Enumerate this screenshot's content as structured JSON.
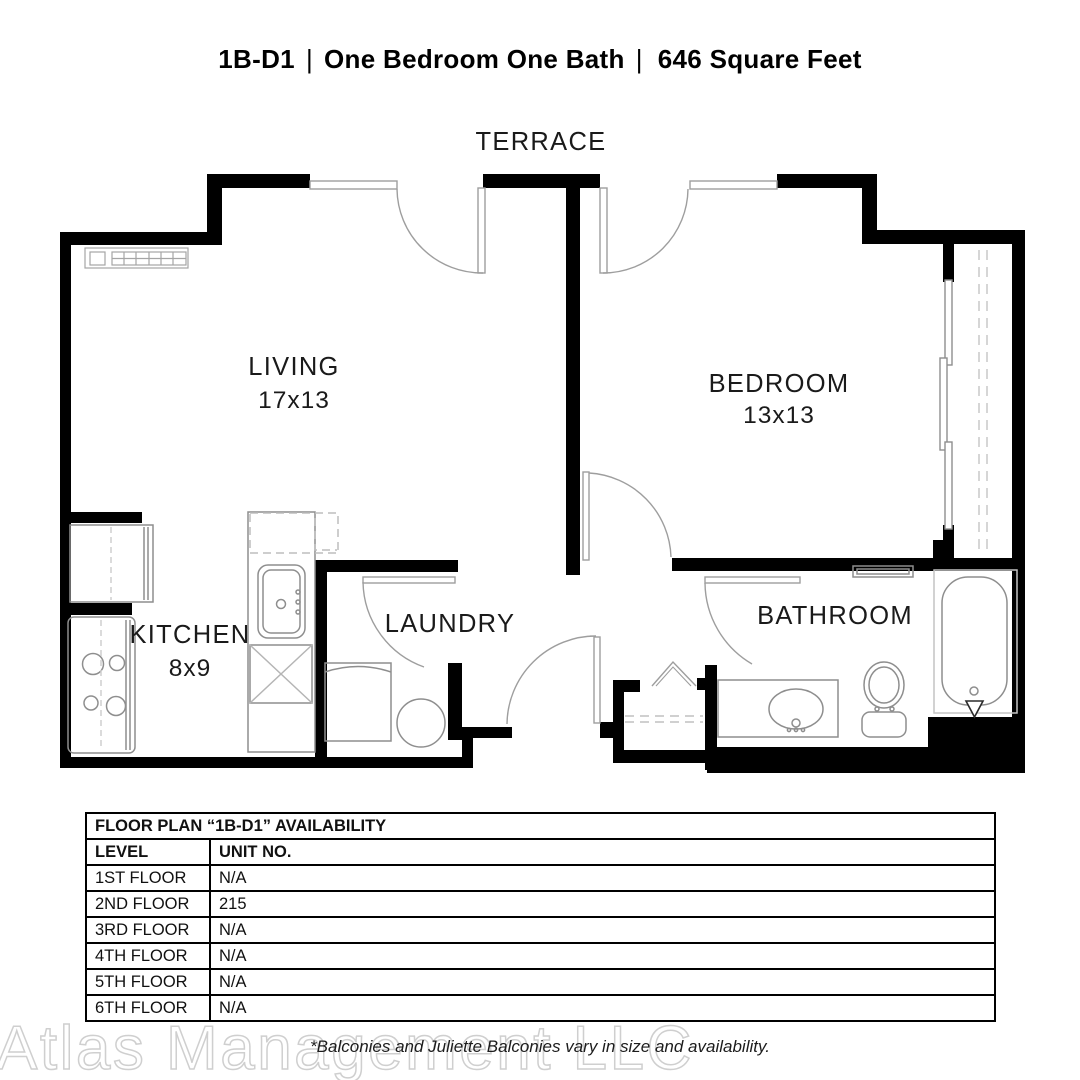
{
  "header": {
    "code": "1B-D1",
    "sep": "|",
    "name": "One Bedroom One Bath",
    "sqft": "646 Square Feet"
  },
  "plan": {
    "terrace": "TERRACE",
    "living": {
      "name": "LIVING",
      "dims": "17x13"
    },
    "bedroom": {
      "name": "BEDROOM",
      "dims": "13x13"
    },
    "kitchen": {
      "name": "KITCHEN",
      "dims": "8x9"
    },
    "laundry": {
      "name": "LAUNDRY"
    },
    "bathroom": {
      "name": "BATHROOM"
    }
  },
  "table": {
    "title": "FLOOR PLAN “1B-D1” AVAILABILITY",
    "columns": [
      "LEVEL",
      "UNIT NO."
    ],
    "rows": [
      {
        "level": "1ST FLOOR",
        "unit": "N/A"
      },
      {
        "level": "2ND FLOOR",
        "unit": "215"
      },
      {
        "level": "3RD FLOOR",
        "unit": "N/A"
      },
      {
        "level": "4TH FLOOR",
        "unit": "N/A"
      },
      {
        "level": "5TH FLOOR",
        "unit": "N/A"
      },
      {
        "level": "6TH FLOOR",
        "unit": "N/A"
      }
    ]
  },
  "footer": {
    "watermark": "Atlas Management LLC",
    "note": "*Balconies and Juliette Balconies vary in size and availability."
  },
  "colors": {
    "wall": "#000000",
    "fixture": "#8e8e8e",
    "text": "#1a1a1a"
  }
}
